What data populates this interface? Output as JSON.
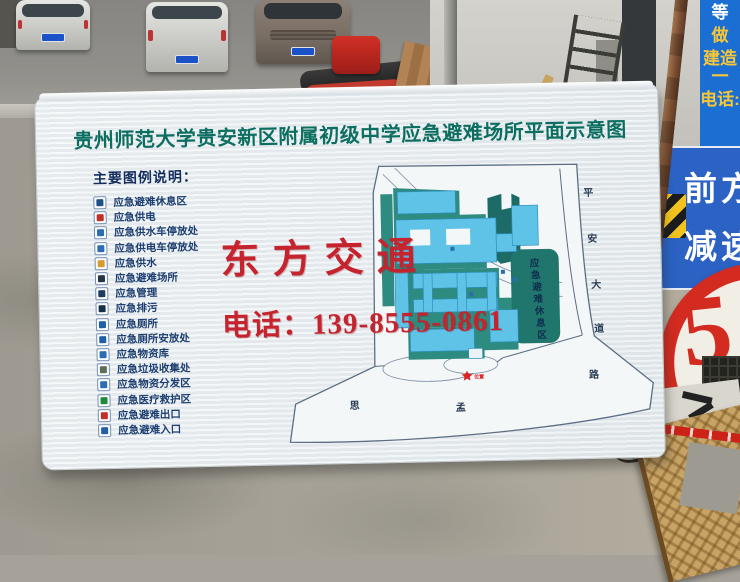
{
  "board": {
    "title": "贵州师范大学贵安新区附属初级中学应急避难场所平面示意图",
    "title_color": "#0c6e61",
    "legend": {
      "heading": "主要图例说明：",
      "text_color": "#1c3e70",
      "heading_color": "#142f5e",
      "items": [
        {
          "label": "应急避难休息区",
          "icon": "shelter-rest-icon",
          "color": "#1d4f8a"
        },
        {
          "label": "应急供电",
          "icon": "power-icon",
          "color": "#c03028"
        },
        {
          "label": "应急供水车停放处",
          "icon": "water-truck-icon",
          "color": "#2a6db5"
        },
        {
          "label": "应急供电车停放处",
          "icon": "power-truck-icon",
          "color": "#2a6db5"
        },
        {
          "label": "应急供水",
          "icon": "faucet-icon",
          "color": "#d89b30"
        },
        {
          "label": "应急避难场所",
          "icon": "evacuation-icon",
          "color": "#22364a"
        },
        {
          "label": "应急管理",
          "icon": "management-icon",
          "color": "#1d3a5f"
        },
        {
          "label": "应急排污",
          "icon": "sewage-icon",
          "color": "#16324a"
        },
        {
          "label": "应急厕所",
          "icon": "toilet-icon",
          "color": "#1f5fa8"
        },
        {
          "label": "应急厕所安放处",
          "icon": "toilet-place-icon",
          "color": "#1f5fa8"
        },
        {
          "label": "应急物资库",
          "icon": "supplies-store-icon",
          "color": "#2a6db5"
        },
        {
          "label": "应急垃圾收集处",
          "icon": "garbage-icon",
          "color": "#5c6e5a"
        },
        {
          "label": "应急物资分发区",
          "icon": "supplies-dist-icon",
          "color": "#2a6db5"
        },
        {
          "label": "应急医疗救护区",
          "icon": "medical-icon",
          "color": "#1a8a3c"
        },
        {
          "label": "应急避难出口",
          "icon": "exit-icon",
          "color": "#c03028"
        },
        {
          "label": "应急避难入口",
          "icon": "entrance-icon",
          "color": "#1f5fa8"
        }
      ]
    },
    "watermark": {
      "line1": "东方交通",
      "line2": "电话：139-8555-0861",
      "color": "#c5242e"
    },
    "map": {
      "rest_area_label": "应急避难休息区",
      "road_right": "平安大道",
      "road_bottom": "思孟路",
      "star_label": "位置",
      "colors": {
        "building": "#5fc3e8",
        "building_stroke": "#2f8fbe",
        "green": "#2e8b80",
        "green_dark": "#1c6b66",
        "rest_area": "#20756d",
        "outline": "#5c6e84",
        "star": "#e02020"
      }
    }
  },
  "scene": {
    "traffic_sign": {
      "line1": "前方",
      "line2": "减速",
      "bg": "#2b62c4"
    },
    "warehouse_sign": {
      "number": "5",
      "suffix": "号库",
      "color": "#d42b20"
    },
    "banner": {
      "bg": "#1b6ed2",
      "chars": [
        {
          "text": "等",
          "color": "#ffffff"
        },
        {
          "text": "做",
          "color": "#f5c63a"
        },
        {
          "text": "建造一",
          "color": "#f5c63a"
        },
        {
          "text": "电话:",
          "color": "#f5c63a"
        }
      ]
    }
  }
}
